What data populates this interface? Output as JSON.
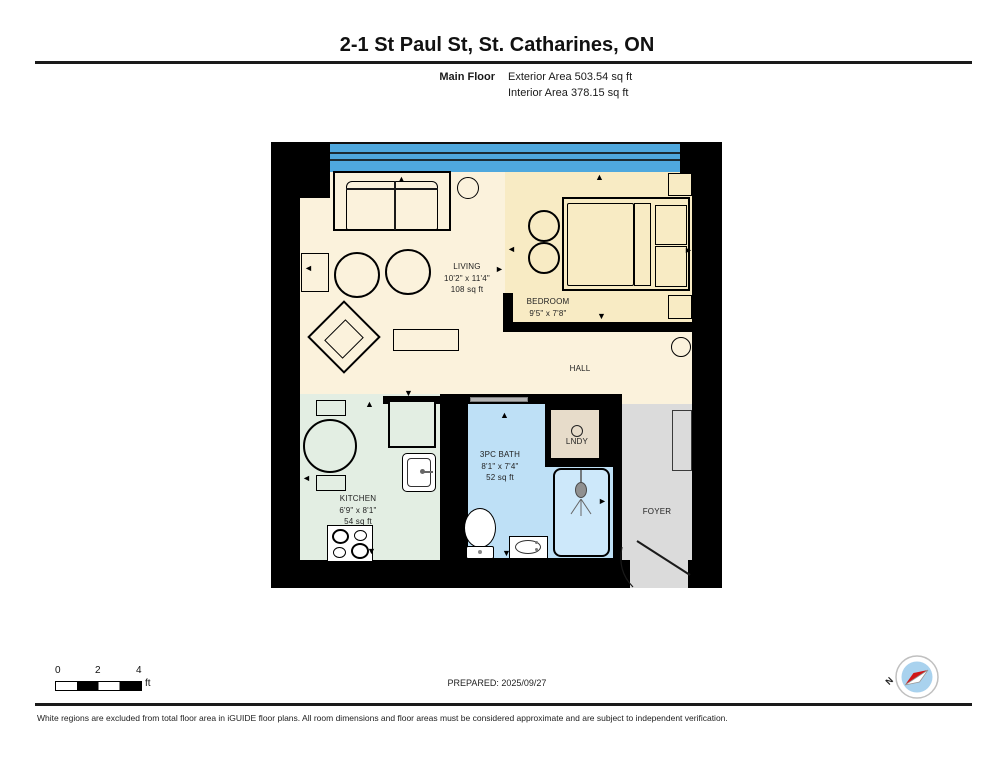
{
  "header": {
    "title": "2-1 St Paul St, St. Catharines, ON",
    "floor_label": "Main Floor",
    "exterior_area": "Exterior Area 503.54 sq ft",
    "interior_area": "Interior Area 378.15 sq ft"
  },
  "rooms": {
    "living": {
      "name": "LIVING",
      "dims": "10'2\" x 11'4\"",
      "area": "108 sq ft"
    },
    "bedroom": {
      "name": "BEDROOM",
      "dims": "9'5\" x 7'8\""
    },
    "hall": {
      "name": "HALL"
    },
    "kitchen": {
      "name": "KITCHEN",
      "dims": "6'9\" x 8'1\"",
      "area": "54 sq ft"
    },
    "bath": {
      "name": "3PC BATH",
      "dims": "8'1\" x 7'4\"",
      "area": "52 sq ft"
    },
    "laundry": {
      "name": "LNDY"
    },
    "foyer": {
      "name": "FOYER"
    }
  },
  "scale_bar": {
    "labels": [
      "0",
      "2",
      "4"
    ],
    "unit": "ft"
  },
  "compass": {
    "north_label": "N"
  },
  "footer": {
    "prepared": "PREPARED: 2025/09/27",
    "disclaimer": "White regions are excluded from total floor area in iGUIDE floor plans. All room dimensions and floor areas must be considered approximate and are subject to independent verification."
  },
  "icons": {
    "arrow_up": "▲",
    "arrow_down": "▼",
    "arrow_left": "◄",
    "arrow_right": "►"
  },
  "colors": {
    "wall": "#000000",
    "window": "#4FA8DE",
    "floor_living_hall": "#FBF2DC",
    "floor_bedroom": "#F8EBC4",
    "floor_kitchen": "#E3EEE3",
    "floor_bath": "#BEE0F6",
    "floor_laundry": "#E7DCCA",
    "floor_foyer": "#DBDBDB",
    "compass_needle_red": "#D01616",
    "compass_face_blue": "#A9D2EE"
  }
}
